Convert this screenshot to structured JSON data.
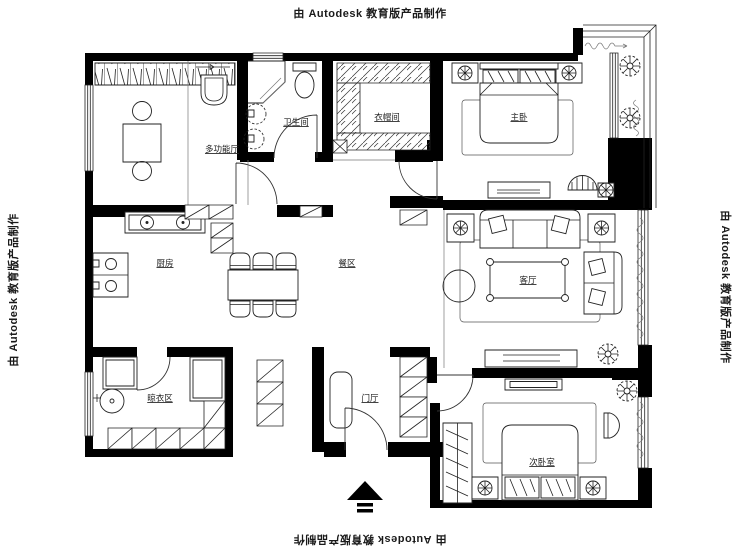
{
  "watermark": {
    "text": "由 Autodesk 教育版产品制作"
  },
  "rooms": {
    "multi_function": {
      "label": "多功能厅"
    },
    "bathroom": {
      "label": "卫生间"
    },
    "cloakroom": {
      "label": "衣帽间"
    },
    "master_bedroom": {
      "label": "主卧"
    },
    "kitchen": {
      "label": "厨房"
    },
    "dining": {
      "label": "餐区"
    },
    "living": {
      "label": "客厅"
    },
    "laundry": {
      "label": "晾衣区"
    },
    "entry": {
      "label": "门厅"
    },
    "second_bedroom": {
      "label": "次卧室"
    }
  },
  "colors": {
    "wall": "#000000",
    "line": "#222222",
    "background": "#ffffff"
  }
}
